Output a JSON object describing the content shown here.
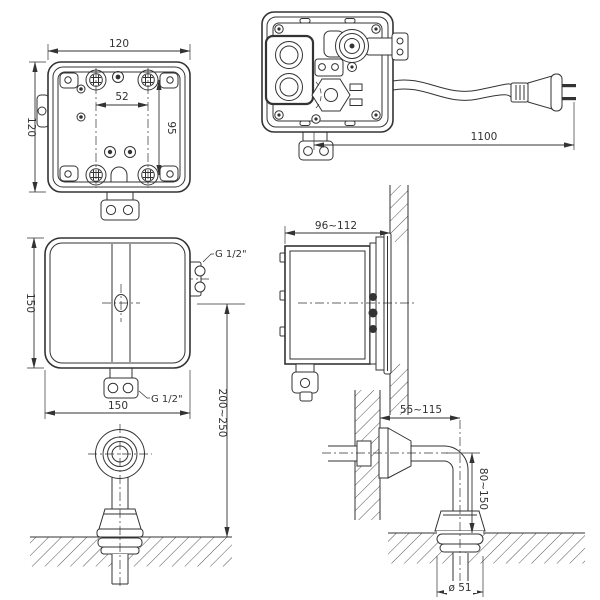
{
  "drawing": {
    "type": "technical-installation-diagram",
    "subject": "concealed sensor flush valve with spout",
    "colors": {
      "line": "#333333",
      "background": "#ffffff"
    },
    "views": {
      "back_panel": {
        "width": "120",
        "height": "120",
        "hole_spacing_horizontal": "52",
        "hole_spacing_vertical": "95"
      },
      "internal_unit": {
        "cable_length": "1100"
      },
      "front_cover": {
        "height": "150",
        "width": "150",
        "inlet_thread": "G 1/2\"",
        "outlet_thread": "G 1/2\"",
        "mounting_height": "200~250"
      },
      "side_mounted": {
        "embed_depth": "96~112"
      },
      "spout_side": {
        "wall_clearance": "55~115",
        "spout_height": "80~150",
        "escutcheon_diameter": "ø 51"
      }
    }
  }
}
